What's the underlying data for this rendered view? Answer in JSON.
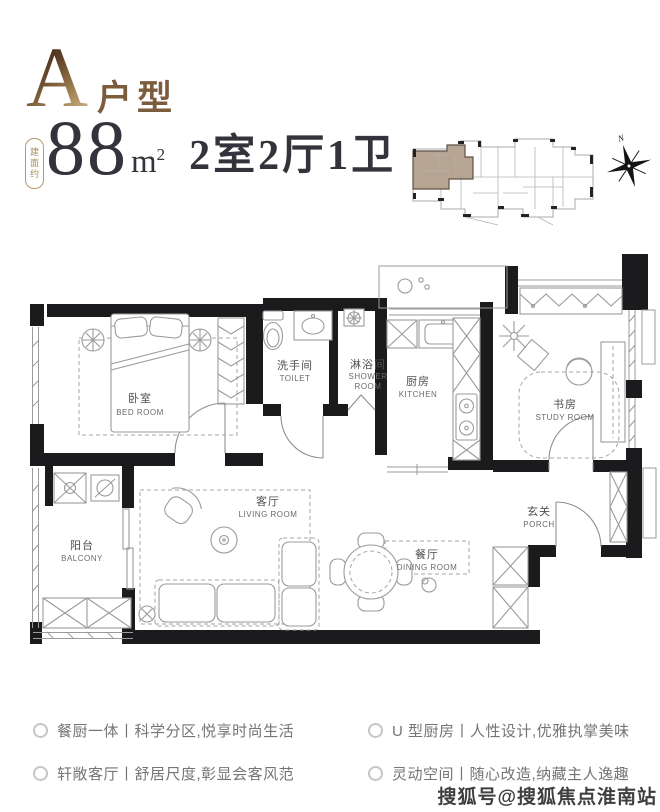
{
  "header": {
    "unit_letter": "A",
    "unit_type": "户型",
    "area_prefix": "建面约",
    "area_value": "88",
    "area_unit": "m",
    "area_exp": "2",
    "rooms_summary": "2室2厅1卫"
  },
  "key_plan": {
    "north": "N"
  },
  "rooms": {
    "bedroom": {
      "cn": "卧室",
      "en": "BED ROOM"
    },
    "toilet": {
      "cn": "洗手间",
      "en": "TOILET"
    },
    "shower": {
      "cn": "淋浴间",
      "en1": "SHOWER",
      "en2": "ROOM"
    },
    "kitchen": {
      "cn": "厨房",
      "en": "KITCHEN"
    },
    "study": {
      "cn": "书房",
      "en": "STUDY ROOM"
    },
    "balcony": {
      "cn": "阳台",
      "en": "BALCONY"
    },
    "living": {
      "cn": "客厅",
      "en": "LIVING ROOM"
    },
    "dining": {
      "cn": "餐厅",
      "en": "DINING ROOM"
    },
    "porch": {
      "cn": "玄关",
      "en": "PORCH"
    }
  },
  "features": [
    {
      "label": "餐厨一体丨科学分区,悦享时尚生活"
    },
    {
      "label": "轩敞客厅丨舒居尺度,彰显会客风范"
    },
    {
      "label": "U 型厨房丨人性设计,优雅执掌美味"
    },
    {
      "label": "灵动空间丨随心改造,纳藏主人逸趣"
    }
  ],
  "watermark": "搜狐号@搜狐焦点淮南站",
  "colors": {
    "accent_brown": "#7b5c3d",
    "text_dark": "#33333c",
    "badge_gold": "#ad9166",
    "unit_highlight": "#b6a593",
    "wall": "#1b1b1d"
  }
}
